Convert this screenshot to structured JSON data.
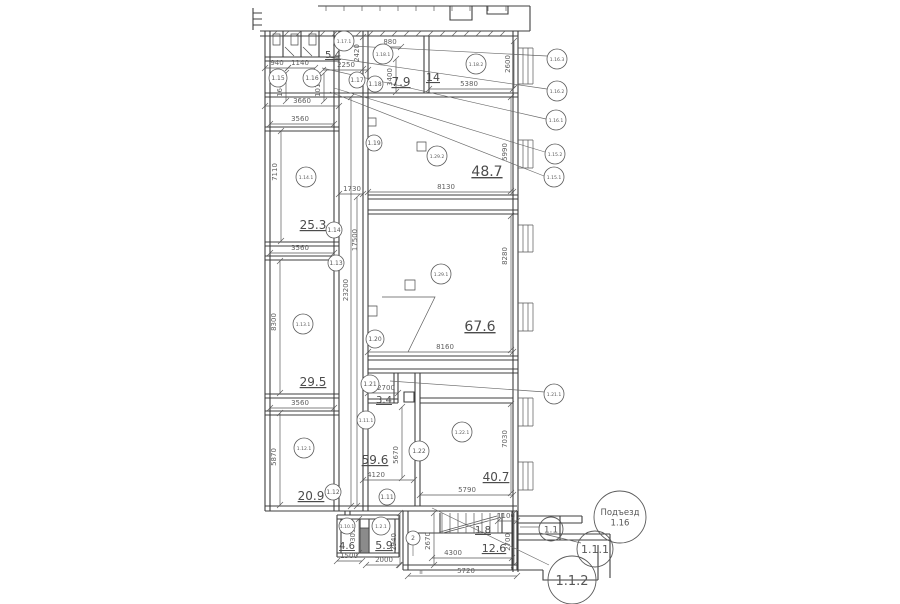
{
  "drawing": {
    "title": "floor-plan",
    "bg_color": "#ffffff",
    "line_color": "#3f3f3f",
    "text_color": "#575757"
  },
  "room_tags": [
    {
      "label": "1.17.1",
      "x": 344,
      "y": 41,
      "r": 10
    },
    {
      "label": "1.18.1",
      "x": 383,
      "y": 54,
      "r": 10
    },
    {
      "label": "1.18.2",
      "x": 476,
      "y": 64,
      "r": 10
    },
    {
      "label": "1.15",
      "x": 278,
      "y": 78,
      "r": 9
    },
    {
      "label": "1.16",
      "x": 312,
      "y": 78,
      "r": 9
    },
    {
      "label": "1.17",
      "x": 357,
      "y": 80,
      "r": 8
    },
    {
      "label": "1.18",
      "x": 375,
      "y": 84,
      "r": 8
    },
    {
      "label": "1.16.3",
      "x": 557,
      "y": 59,
      "r": 10
    },
    {
      "label": "1.16.2",
      "x": 557,
      "y": 91,
      "r": 10
    },
    {
      "label": "1.16.1",
      "x": 556,
      "y": 120,
      "r": 10
    },
    {
      "label": "1.15.2",
      "x": 555,
      "y": 154,
      "r": 10
    },
    {
      "label": "1.15.1",
      "x": 554,
      "y": 177,
      "r": 10
    },
    {
      "label": "1.19",
      "x": 374,
      "y": 143,
      "r": 8
    },
    {
      "label": "1.14.1",
      "x": 306,
      "y": 177,
      "r": 10
    },
    {
      "label": "1.14",
      "x": 334,
      "y": 230,
      "r": 8
    },
    {
      "label": "1.13",
      "x": 336,
      "y": 263,
      "r": 8
    },
    {
      "label": "1.13.1",
      "x": 303,
      "y": 324,
      "r": 10
    },
    {
      "label": "1.29.2",
      "x": 437,
      "y": 156,
      "r": 10
    },
    {
      "label": "1.29.1",
      "x": 441,
      "y": 274,
      "r": 10
    },
    {
      "label": "1.20",
      "x": 375,
      "y": 339,
      "r": 9
    },
    {
      "label": "1.21",
      "x": 370,
      "y": 384,
      "r": 9
    },
    {
      "label": "1.21.1",
      "x": 554,
      "y": 394,
      "r": 10
    },
    {
      "label": "1.11.1",
      "x": 366,
      "y": 420,
      "r": 9
    },
    {
      "label": "1.12.1",
      "x": 304,
      "y": 448,
      "r": 10
    },
    {
      "label": "1.22",
      "x": 419,
      "y": 451,
      "r": 10
    },
    {
      "label": "1.22.1",
      "x": 462,
      "y": 432,
      "r": 10
    },
    {
      "label": "1.12",
      "x": 333,
      "y": 492,
      "r": 8
    },
    {
      "label": "1.11",
      "x": 387,
      "y": 497,
      "r": 8
    },
    {
      "label": "1.10.1",
      "x": 347,
      "y": 526,
      "r": 8
    },
    {
      "label": "1.2.1",
      "x": 381,
      "y": 526,
      "r": 9
    },
    {
      "label": "2",
      "x": 413,
      "y": 538,
      "r": 7
    }
  ],
  "big_circles": [
    {
      "lines": [
        "Подъезд",
        "1.16"
      ],
      "x": 620,
      "y": 517,
      "r": 26,
      "fs": 8.5
    },
    {
      "lines": [
        "1.1"
      ],
      "x": 551,
      "y": 529,
      "r": 12,
      "fs": 9
    },
    {
      "lines": [
        "1.1.1"
      ],
      "x": 595,
      "y": 549,
      "r": 18,
      "fs": 11
    },
    {
      "lines": [
        "1.1.2"
      ],
      "x": 572,
      "y": 580,
      "r": 24,
      "fs": 13
    }
  ],
  "areas": [
    {
      "text": "5.4",
      "x": 333,
      "y": 58,
      "fs": 10
    },
    {
      "text": "7.9",
      "x": 401,
      "y": 86,
      "fs": 12
    },
    {
      "text": "14",
      "x": 433,
      "y": 81,
      "fs": 11
    },
    {
      "text": "48.7",
      "x": 487,
      "y": 176,
      "fs": 14
    },
    {
      "text": "25.3",
      "x": 313,
      "y": 229,
      "fs": 12
    },
    {
      "text": "67.6",
      "x": 480,
      "y": 331,
      "fs": 14
    },
    {
      "text": "29.5",
      "x": 313,
      "y": 386,
      "fs": 12
    },
    {
      "text": "3.4",
      "x": 384,
      "y": 403,
      "fs": 10
    },
    {
      "text": "59.6",
      "x": 375,
      "y": 464,
      "fs": 12
    },
    {
      "text": "40.7",
      "x": 496,
      "y": 481,
      "fs": 12
    },
    {
      "text": "20.9",
      "x": 311,
      "y": 500,
      "fs": 12
    },
    {
      "text": "4.6",
      "x": 347,
      "y": 549,
      "fs": 10
    },
    {
      "text": "5.9",
      "x": 384,
      "y": 549,
      "fs": 11
    },
    {
      "text": "1.8",
      "x": 483,
      "y": 533,
      "fs": 10
    },
    {
      "text": "12.6",
      "x": 494,
      "y": 552,
      "fs": 11
    }
  ],
  "dims": [
    {
      "text": "940",
      "x": 277,
      "y": 65,
      "rot": "h",
      "line": [
        265,
        68,
        288,
        68
      ]
    },
    {
      "text": "1140",
      "x": 300,
      "y": 65,
      "rot": "h",
      "line": [
        288,
        68,
        315,
        68
      ]
    },
    {
      "text": "2250",
      "x": 346,
      "y": 67,
      "rot": "h",
      "line": [
        323,
        70,
        368,
        70
      ]
    },
    {
      "text": "880",
      "x": 390,
      "y": 44,
      "rot": "h",
      "line": [
        378,
        47,
        401,
        47
      ]
    },
    {
      "text": "5380",
      "x": 469,
      "y": 86,
      "rot": "h",
      "line": [
        429,
        89,
        513,
        89
      ]
    },
    {
      "text": "3660",
      "x": 302,
      "y": 103,
      "rot": "h",
      "line": [
        265,
        106,
        339,
        106
      ]
    },
    {
      "text": "3560",
      "x": 300,
      "y": 121,
      "rot": "h",
      "line": [
        270,
        124,
        334,
        124
      ]
    },
    {
      "text": "1730",
      "x": 352,
      "y": 191,
      "rot": "h",
      "line": [
        339,
        194,
        363,
        194
      ]
    },
    {
      "text": "8130",
      "x": 446,
      "y": 189,
      "rot": "h",
      "line": [
        368,
        192,
        513,
        192
      ]
    },
    {
      "text": "3560",
      "x": 300,
      "y": 250,
      "rot": "h",
      "line": [
        270,
        253,
        334,
        253
      ]
    },
    {
      "text": "8160",
      "x": 445,
      "y": 349,
      "rot": "h",
      "line": [
        368,
        352,
        513,
        352
      ]
    },
    {
      "text": "2700",
      "x": 386,
      "y": 390,
      "rot": "h",
      "line": [
        368,
        393,
        398,
        393
      ]
    },
    {
      "text": "3560",
      "x": 300,
      "y": 405,
      "rot": "h",
      "line": [
        270,
        408,
        334,
        408
      ]
    },
    {
      "text": "4120",
      "x": 376,
      "y": 477,
      "rot": "h",
      "line": [
        363,
        480,
        414,
        480
      ]
    },
    {
      "text": "5790",
      "x": 467,
      "y": 492,
      "rot": "h",
      "line": [
        420,
        495,
        513,
        495
      ]
    },
    {
      "text": "1100",
      "x": 506,
      "y": 518,
      "rot": "h",
      "line": [
        498,
        521,
        517,
        521
      ]
    },
    {
      "text": "4300",
      "x": 453,
      "y": 555,
      "rot": "h",
      "line": [
        432,
        558,
        512,
        558
      ]
    },
    {
      "text": "1500",
      "x": 349,
      "y": 558,
      "rot": "h",
      "line": [
        337,
        561,
        362,
        561
      ]
    },
    {
      "text": "2000",
      "x": 384,
      "y": 562,
      "rot": "h",
      "line": [
        366,
        565,
        399,
        565
      ]
    },
    {
      "text": "5720",
      "x": 466,
      "y": 573,
      "rot": "h",
      "line": [
        408,
        576,
        517,
        576
      ]
    },
    {
      "text": "1640",
      "x": 282,
      "y": 88,
      "rot": "v",
      "line": [
        286,
        73,
        286,
        101
      ]
    },
    {
      "text": "1010",
      "x": 320,
      "y": 88,
      "rot": "v",
      "line": [
        324,
        73,
        324,
        101
      ]
    },
    {
      "text": "2420",
      "x": 359,
      "y": 53,
      "rot": "v",
      "line": [
        363,
        37,
        363,
        69
      ]
    },
    {
      "text": "3400",
      "x": 392,
      "y": 77,
      "rot": "v",
      "line": [
        396,
        59,
        396,
        92
      ]
    },
    {
      "text": "2600",
      "x": 510,
      "y": 64,
      "rot": "v",
      "line": [
        514,
        41,
        514,
        88
      ]
    },
    {
      "text": "7110",
      "x": 277,
      "y": 172,
      "rot": "v",
      "line": [
        281,
        131,
        281,
        241
      ]
    },
    {
      "text": "17500",
      "x": 357,
      "y": 240,
      "rot": "v",
      "line": [
        357,
        197,
        357,
        506
      ]
    },
    {
      "text": "23200",
      "x": 348,
      "y": 290,
      "rot": "v",
      "line": [
        351,
        97,
        351,
        506
      ]
    },
    {
      "text": "5990",
      "x": 507,
      "y": 152,
      "rot": "v",
      "line": [
        511,
        97,
        511,
        191
      ]
    },
    {
      "text": "8300",
      "x": 276,
      "y": 322,
      "rot": "v",
      "line": [
        280,
        261,
        280,
        393
      ]
    },
    {
      "text": "8280",
      "x": 507,
      "y": 256,
      "rot": "v",
      "line": [
        511,
        216,
        511,
        350
      ]
    },
    {
      "text": "5870",
      "x": 276,
      "y": 457,
      "rot": "v",
      "line": [
        280,
        413,
        280,
        505
      ]
    },
    {
      "text": "5670",
      "x": 398,
      "y": 455,
      "rot": "v",
      "line": [
        402,
        407,
        402,
        478
      ]
    },
    {
      "text": "7030",
      "x": 507,
      "y": 439,
      "rot": "v",
      "line": [
        511,
        404,
        511,
        493
      ]
    },
    {
      "text": "3090",
      "x": 355,
      "y": 533,
      "rot": "v",
      "line": [
        359,
        519,
        359,
        553
      ]
    },
    {
      "text": "2940",
      "x": 396,
      "y": 542,
      "rot": "v",
      "line": [
        400,
        513,
        400,
        565
      ]
    },
    {
      "text": "2670",
      "x": 430,
      "y": 541,
      "rot": "v",
      "line": [
        434,
        513,
        434,
        565
      ]
    },
    {
      "text": "2700",
      "x": 510,
      "y": 542,
      "rot": "v",
      "line": [
        514,
        513,
        514,
        565
      ]
    }
  ],
  "marks": [
    {
      "text": "II",
      "x": 421,
      "y": 574,
      "fs": 6
    }
  ]
}
